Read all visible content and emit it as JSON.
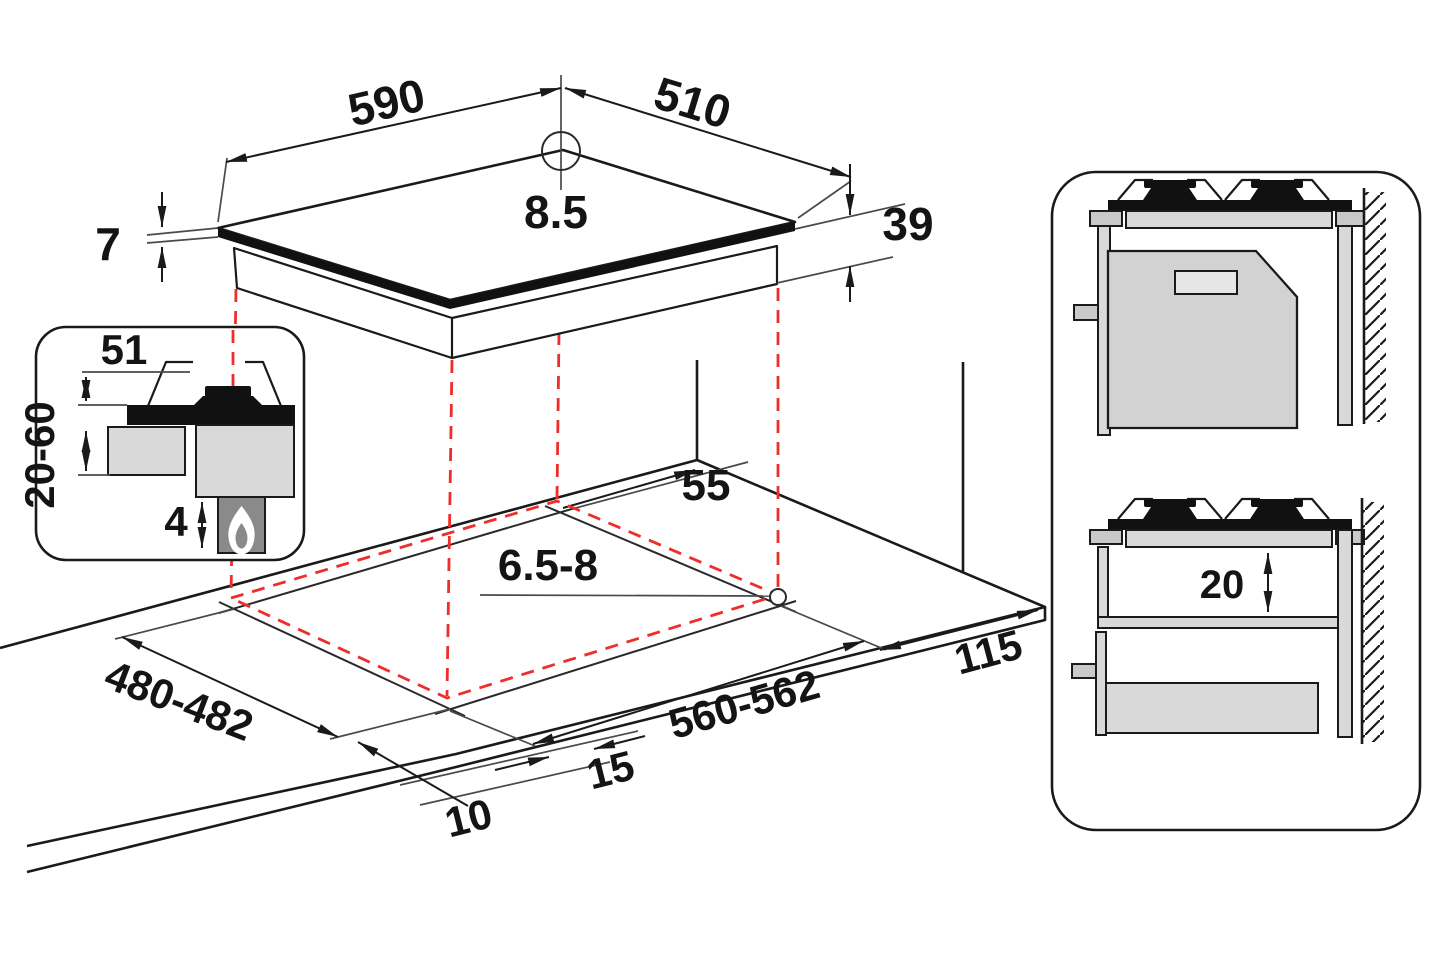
{
  "diagram_title": "Gas hob installation dimensions diagram",
  "colors": {
    "line": "#1a1a1a",
    "projection_red": "#ee2e2a",
    "fill_light": "#d9d9d9",
    "fill_mid": "#8a8a8a",
    "glass_dark": "#111111"
  },
  "hob_view": {
    "width": "590",
    "depth": "510",
    "hole_offset": "8.5",
    "glass_thickness": "7",
    "body_height": "39"
  },
  "burner_detail_inset": {
    "burner_height": "51",
    "worktop_thickness": "20-60",
    "bottom_clearance": "4"
  },
  "worktop_cutout": {
    "rear_clearance": "55",
    "worktop_thickness_range": "6.5-8",
    "cutout_depth": "480-482",
    "cutout_width": "560-562",
    "front_line_gap": "15",
    "front_edge_gap": "10",
    "side_clearance": "115"
  },
  "installation_side_views": {
    "shelf_clearance": "20"
  }
}
